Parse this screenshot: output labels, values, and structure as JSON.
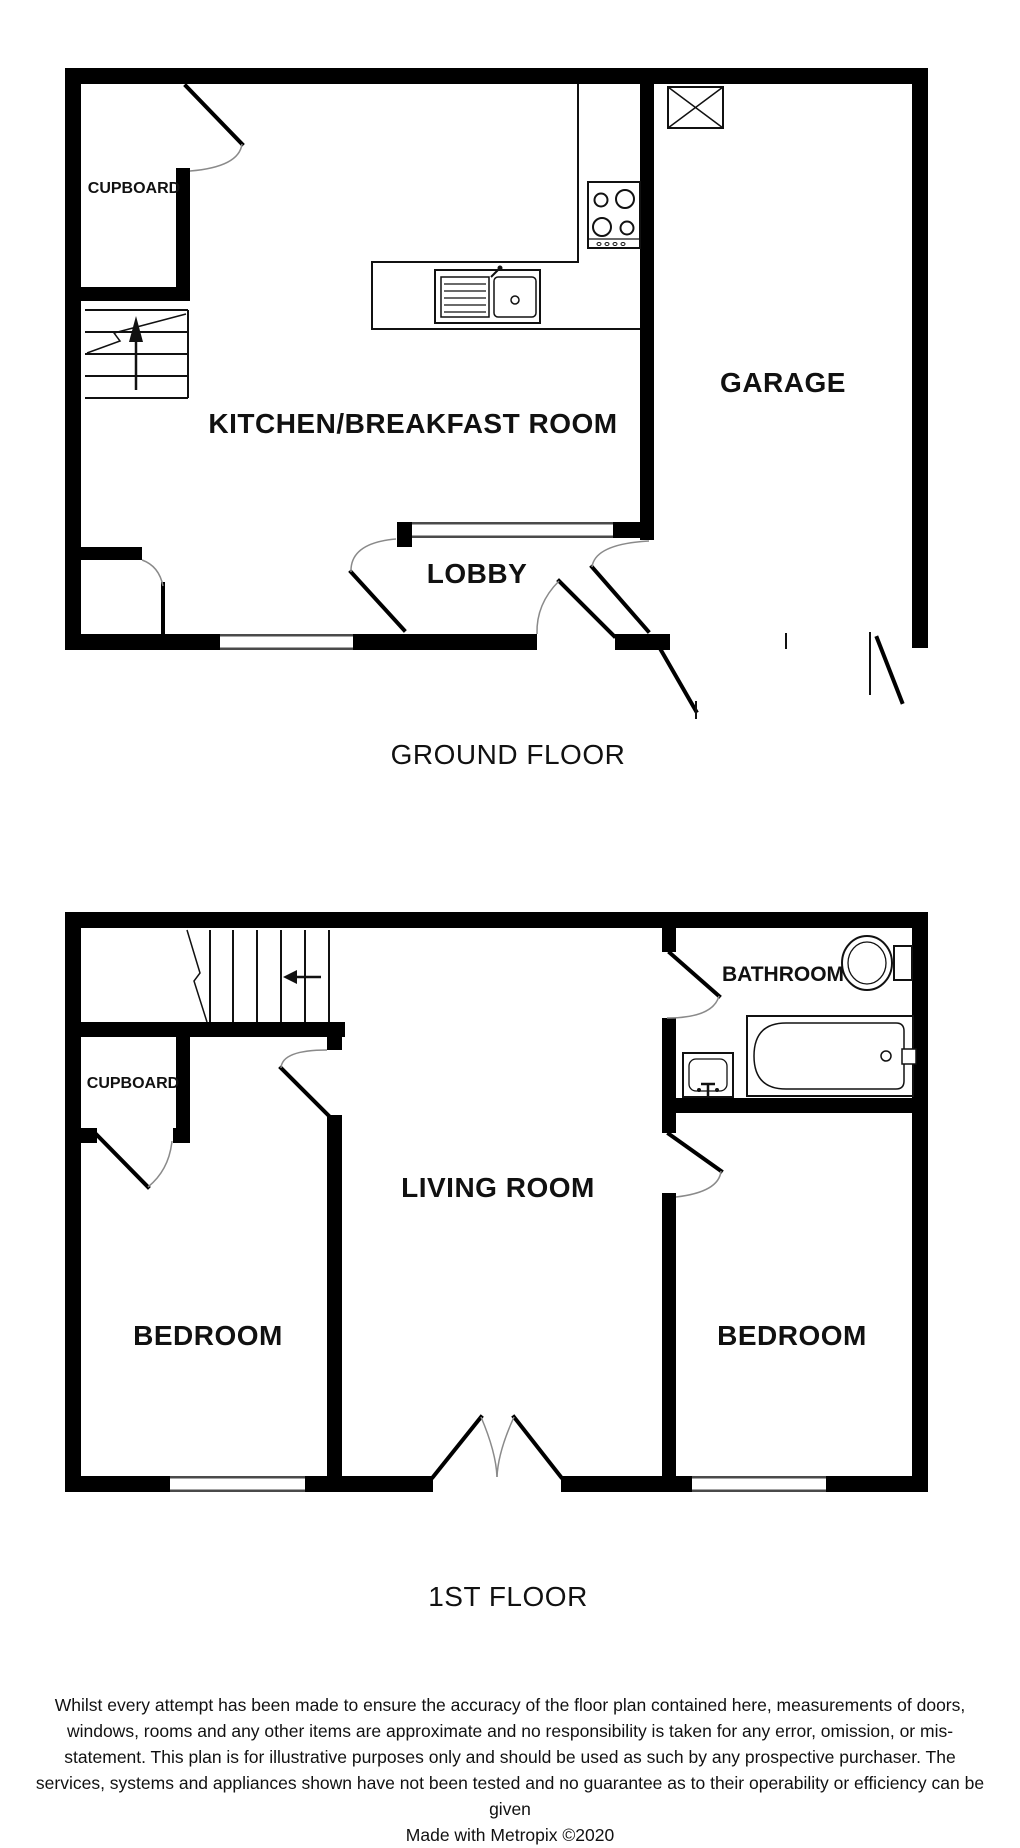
{
  "ground_floor": {
    "title": "GROUND FLOOR",
    "rooms": {
      "cupboard": "CUPBOARD",
      "kitchen_breakfast": "KITCHEN/BREAKFAST ROOM",
      "lobby": "LOBBY",
      "garage": "GARAGE"
    }
  },
  "first_floor": {
    "title": "1ST FLOOR",
    "rooms": {
      "cupboard": "CUPBOARD",
      "bathroom": "BATHROOM",
      "living_room": "LIVING ROOM",
      "bedroom_left": "BEDROOM",
      "bedroom_right": "BEDROOM"
    }
  },
  "footer": {
    "disclaimer": "Whilst every attempt has been made to ensure the accuracy of the floor plan contained here, measurements of doors, windows, rooms and any other items are approximate and no responsibility is taken for any error, omission, or mis-statement. This plan is for illustrative purposes only and should be used as such by any prospective purchaser. The services, systems and appliances shown have not been tested and no guarantee as to their operability or efficiency can be given",
    "credit": "Made with Metropix ©2020"
  },
  "colors": {
    "wall": "#000000",
    "line": "#111111",
    "door_arc": "#8a8a8a",
    "background": "#ffffff"
  }
}
